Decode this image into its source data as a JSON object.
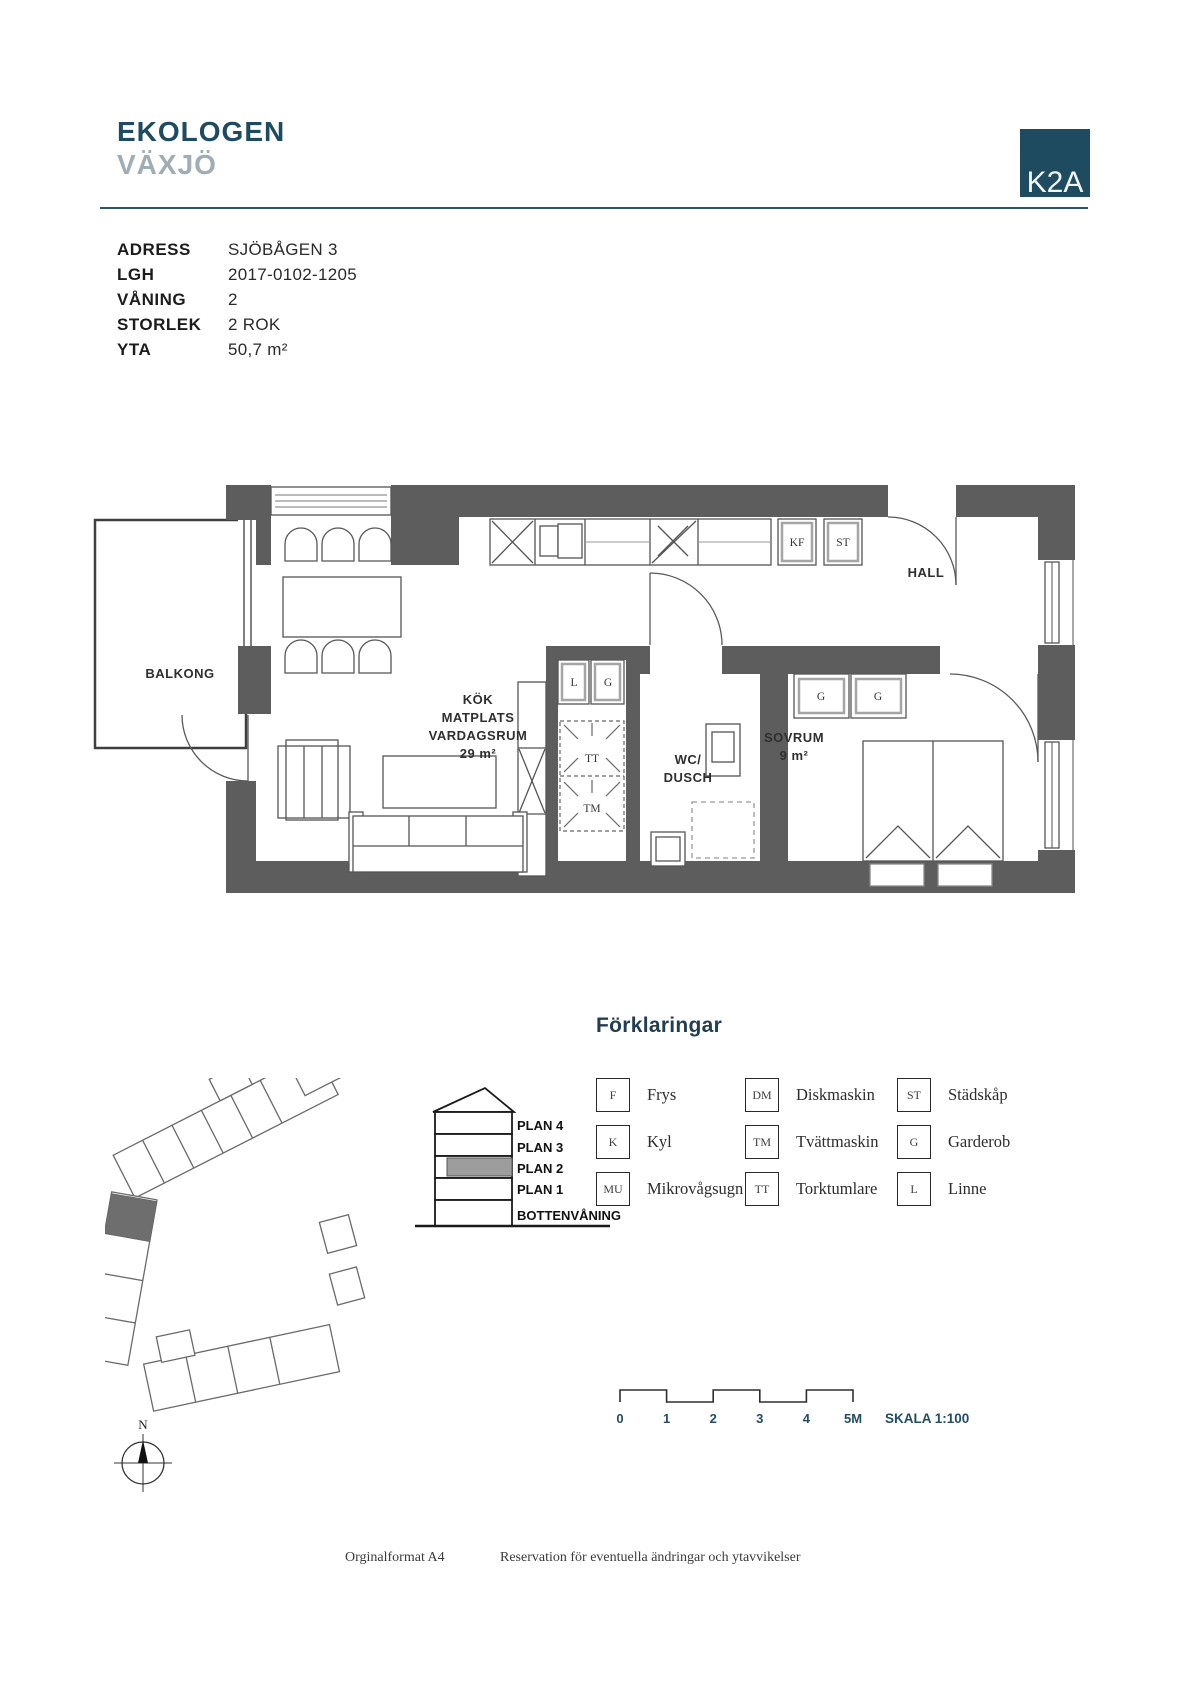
{
  "header": {
    "project": "EKOLOGEN",
    "city": "VÄXJÖ",
    "logo": "K2A"
  },
  "info": {
    "rows": [
      {
        "label": "ADRESS",
        "value": "SJÖBÅGEN 3"
      },
      {
        "label": "LGH",
        "value": "2017-0102-1205"
      },
      {
        "label": "VÅNING",
        "value": "2"
      },
      {
        "label": "STORLEK",
        "value": "2 ROK"
      },
      {
        "label": "YTA",
        "value": "50,7 m²"
      }
    ]
  },
  "plan": {
    "rooms": {
      "balcony": "BALKONG",
      "kitchen_l1": "KÖK",
      "kitchen_l2": "MATPLATS",
      "kitchen_l3": "VARDAGSRUM",
      "kitchen_area": "29 m²",
      "hall": "HALL",
      "wc_l1": "WC/",
      "wc_l2": "DUSCH",
      "bedroom": "SOVRUM",
      "bedroom_area": "9 m²"
    },
    "tags": {
      "kf": "KF",
      "st": "ST",
      "l": "L",
      "g_closet": "G",
      "g_bed1": "G",
      "g_bed2": "G",
      "tt": "TT",
      "tm": "TM"
    }
  },
  "legend": {
    "title": "Förklaringar",
    "items": [
      {
        "abbr": "F",
        "label": "Frys"
      },
      {
        "abbr": "K",
        "label": "Kyl"
      },
      {
        "abbr": "MU",
        "label": "Mikrovågsugn"
      },
      {
        "abbr": "DM",
        "label": "Diskmaskin"
      },
      {
        "abbr": "TM",
        "label": "Tvättmaskin"
      },
      {
        "abbr": "TT",
        "label": "Torktumlare"
      },
      {
        "abbr": "ST",
        "label": "Städskåp"
      },
      {
        "abbr": "G",
        "label": "Garderob"
      },
      {
        "abbr": "L",
        "label": "Linne"
      }
    ]
  },
  "section": {
    "floors": [
      "PLAN 4",
      "PLAN 3",
      "PLAN 2",
      "PLAN 1",
      "BOTTENVÅNING"
    ],
    "highlighted": "PLAN 2"
  },
  "compass": {
    "north": "N"
  },
  "scalebar": {
    "ticks": [
      "0",
      "1",
      "2",
      "3",
      "4",
      "5M"
    ],
    "scale_label": "SKALA 1:100"
  },
  "footer": {
    "format": "Orginalformat A4",
    "disclaimer": "Reservation för eventuella ändringar och ytavvikelser"
  },
  "colors": {
    "navy": "#1e4b5f",
    "gray_blue": "#9fadb6",
    "wall": "#5d5d5d",
    "highlight": "#9d9d9d"
  }
}
